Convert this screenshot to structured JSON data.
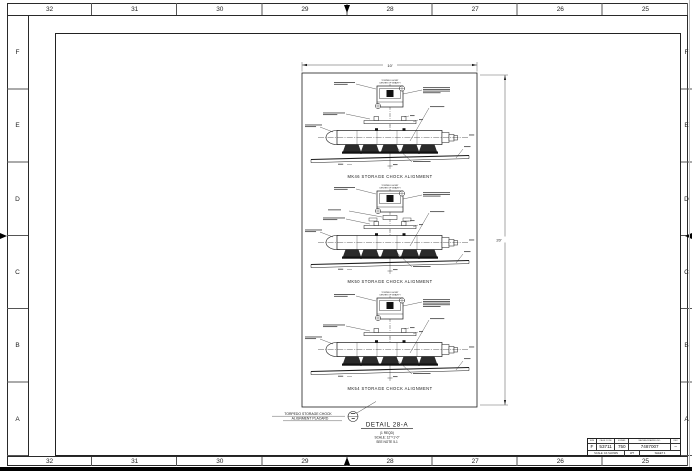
{
  "border": {
    "columns": [
      "32",
      "31",
      "30",
      "29",
      "28",
      "27",
      "26",
      "25"
    ],
    "rows": [
      "F",
      "E",
      "D",
      "C",
      "B",
      "A"
    ]
  },
  "viewport_dims": {
    "width": "10'",
    "height": "20'"
  },
  "details": [
    {
      "caption": "MK46 STORAGE CHOCK ALIGNMENT",
      "cg_line1": "TORPEDO HOIST",
      "cg_line2": "CENTER OF GRAVITY"
    },
    {
      "caption": "MK50 STORAGE CHOCK ALIGNMENT",
      "cg_line1": "TORPEDO HOIST",
      "cg_line2": "CENTER OF GRAVITY"
    },
    {
      "caption": "MK54 STORAGE CHOCK ALIGNMENT",
      "cg_line1": "TORPEDO HOIST",
      "cg_line2": "CENTER OF GRAVITY"
    }
  ],
  "callout": {
    "line1": "TORPEDO STORAGE CHOCK",
    "line2": "ALIGNMENT PLACARD"
  },
  "detail_block": {
    "title": "DETAIL 28-A",
    "qty": "(1 REQD)",
    "scale": "SCALE: 12\"=1'-0\"",
    "note": "SEE NOTE 5-1"
  },
  "title_block": {
    "headers": [
      "SIZE",
      "CAGE CODE",
      "ESWBS",
      "NAVSEA DRAWING NO.",
      "REV"
    ],
    "values": [
      "F",
      "53711",
      "750",
      "7487007",
      "–"
    ],
    "footer": {
      "scale": "SCALE: AS SHOWN",
      "wt": "WT",
      "sheet": "SHEET 4"
    }
  }
}
